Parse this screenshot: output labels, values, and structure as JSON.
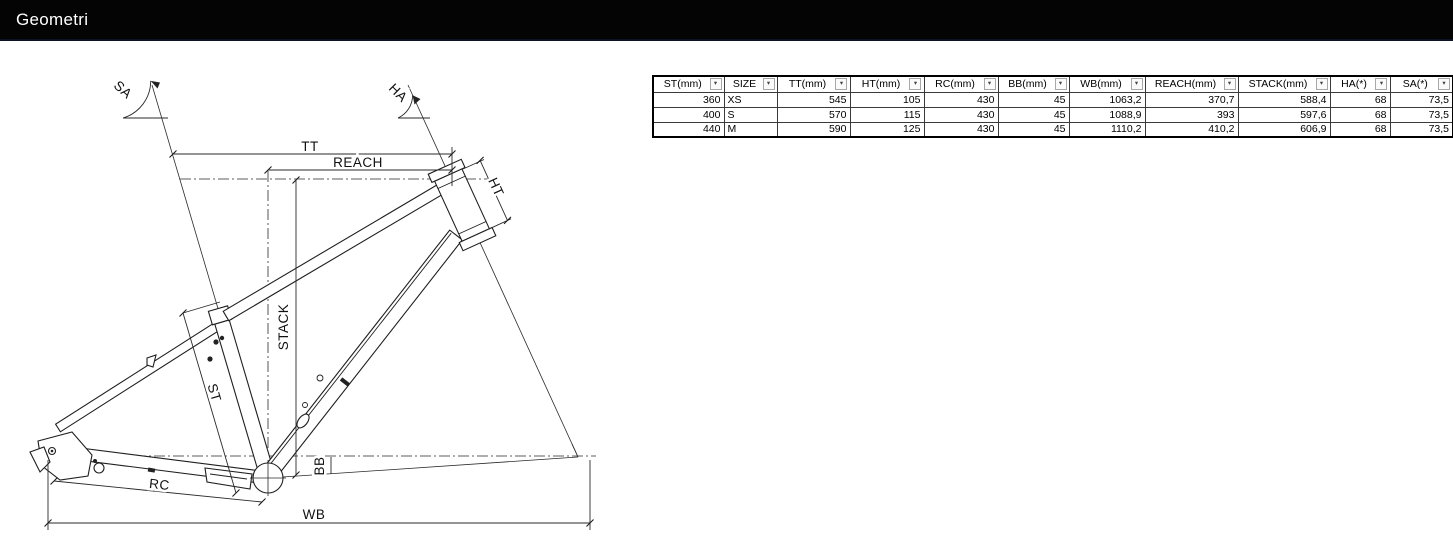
{
  "title_bar": {
    "title": "Geometri"
  },
  "colors": {
    "title_bar_bg": "#040404",
    "title_fg": "#ffffff",
    "line": "#1f1f1f"
  },
  "diagram": {
    "description": "CAD wireframe drawing of a hardtail bicycle frame with dimension annotations",
    "labels": {
      "sa": "SA",
      "ha": "HA",
      "tt": "TT",
      "reach": "REACH",
      "stack": "STACK",
      "st": "ST",
      "ht": "HT",
      "bb": "BB",
      "rc": "RC",
      "wb": "WB"
    }
  },
  "table": {
    "filter_icon": "▾",
    "columns": [
      "ST(mm)",
      "SIZE",
      "TT(mm)",
      "HT(mm)",
      "RC(mm)",
      "BB(mm)",
      "WB(mm)",
      "REACH(mm)",
      "STACK(mm)",
      "HA(*)",
      "SA(*)"
    ],
    "rows": [
      [
        "360",
        "XS",
        "545",
        "105",
        "430",
        "45",
        "1063,2",
        "370,7",
        "588,4",
        "68",
        "73,5"
      ],
      [
        "400",
        "S",
        "570",
        "115",
        "430",
        "45",
        "1088,9",
        "393",
        "597,6",
        "68",
        "73,5"
      ],
      [
        "440",
        "M",
        "590",
        "125",
        "430",
        "45",
        "1110,2",
        "410,2",
        "606,9",
        "68",
        "73,5"
      ]
    ]
  }
}
